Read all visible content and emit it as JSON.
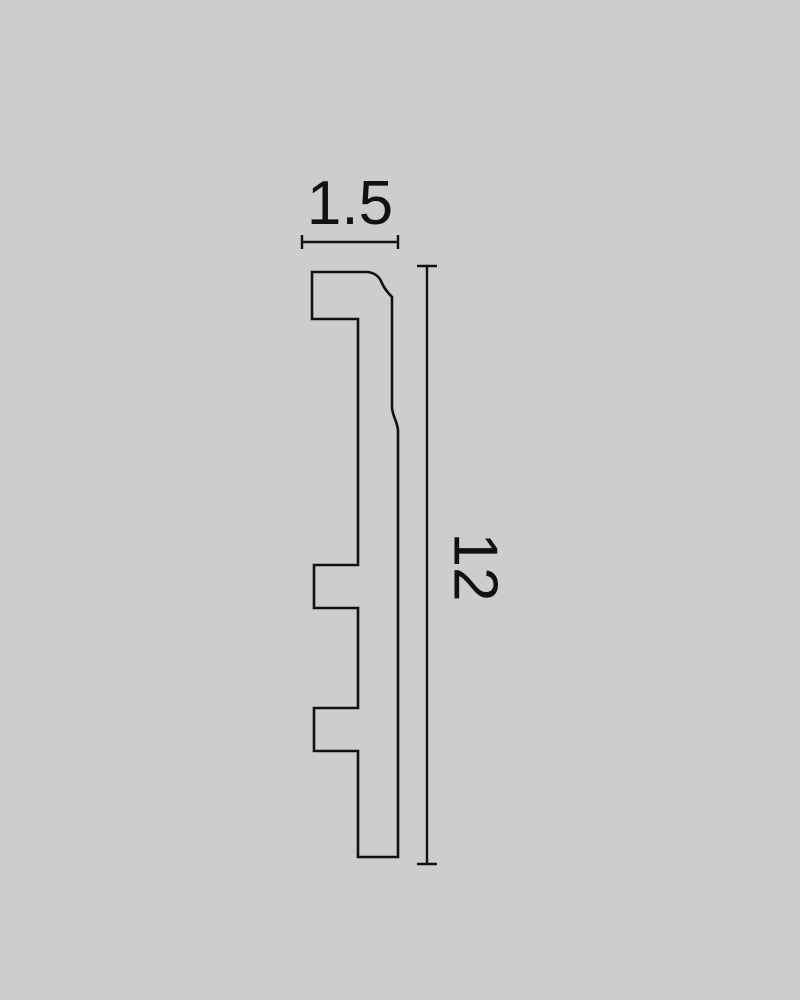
{
  "diagram": {
    "width_dimension": {
      "label": "1.5"
    },
    "height_dimension": {
      "label": "12"
    },
    "profile_path": "M 312 272 L 368 272 C 375 273 379 277 381 281 C 383 286 386 291 392 297 L 392 408 C 393 417 397 421 398 430 L 398 857 L 358 857 L 358 751 L 314 751 L 314 708 L 358 708 L 358 608 L 314 608 L 314 565 L 358 565 L 358 319 L 312 319 Z",
    "colors": {
      "background": "#cdcdcd",
      "line": "#111111"
    }
  }
}
